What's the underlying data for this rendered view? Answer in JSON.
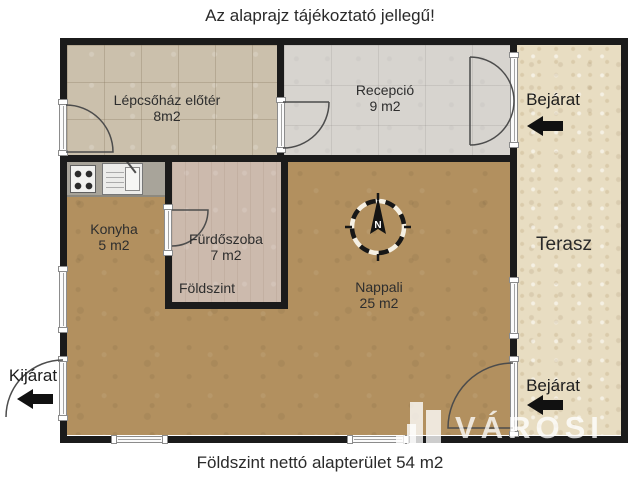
{
  "title": "Az alaprajz tájékoztató jellegű!",
  "footer": "Földszint nettó alapterület 54 m2",
  "rooms": {
    "stairwell": {
      "name": "Lépcsőház előtér",
      "area": "8m2"
    },
    "reception": {
      "name": "Recepció",
      "area": "9 m2"
    },
    "kitchen": {
      "name": "Konyha",
      "area": "5 m2"
    },
    "bathroom": {
      "name": "Fürdőszoba",
      "area": "7 m2",
      "level_label": "Földszint"
    },
    "living": {
      "name": "Nappali",
      "area": "25 m2"
    },
    "terrace": {
      "name": "Terasz"
    }
  },
  "annotations": {
    "entrance_top": "Bejárat",
    "entrance_bottom": "Bejárat",
    "exit": "Kijárat"
  },
  "compass": {
    "north_label": "N"
  },
  "watermark": {
    "brand": "VÁROSI"
  },
  "colors": {
    "wall": "#1b1b1b",
    "wood_floor": "#b2905f",
    "stairwell_tile": "#cbc0ac",
    "reception_floor": "#d7d4cf",
    "terrace_tile": "#e8ddc2",
    "bathroom_floor": "#ccbaad",
    "counter": "#a8a49a",
    "arrow": "#111111",
    "text": "#2a2a2a"
  }
}
